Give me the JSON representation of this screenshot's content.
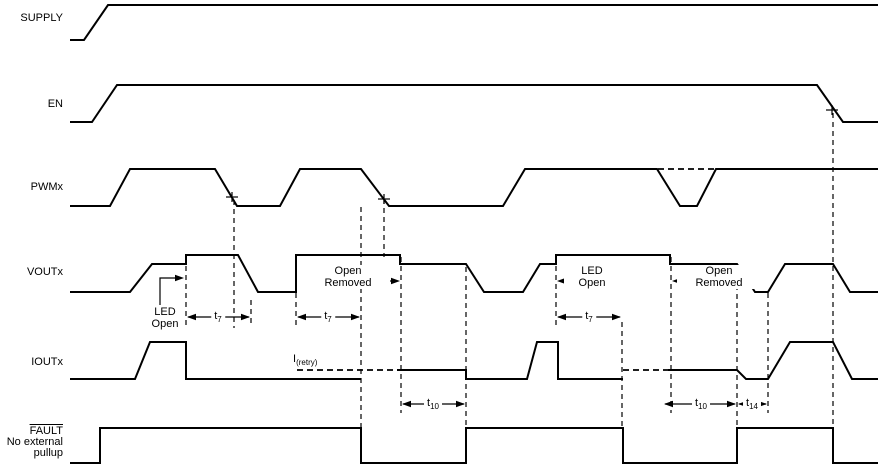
{
  "figure": {
    "background": "#ffffff",
    "line_color": "#000000"
  },
  "signals": {
    "supply": {
      "label": "SUPPLY"
    },
    "en": {
      "label": "EN"
    },
    "pwmx": {
      "label": "PWMx"
    },
    "voutx": {
      "label": "VOUTx"
    },
    "ioutx": {
      "label": "IOUTx"
    },
    "fault": {
      "label": "FAULT",
      "note_line1": "No external",
      "note_line2": "pullup"
    }
  },
  "annotations": {
    "led_open_1": {
      "line1": "LED",
      "line2": "Open"
    },
    "open_removed_1": {
      "line1": "Open",
      "line2": "Removed"
    },
    "led_open_2": {
      "line1": "LED",
      "line2": "Open"
    },
    "open_removed_2": {
      "line1": "Open",
      "line2": "Removed"
    },
    "i_retry": {
      "main": "I",
      "sub": "(retry)"
    }
  },
  "timing_labels": {
    "t7": {
      "main": "t",
      "sub": "7"
    },
    "t10": {
      "main": "t",
      "sub": "10"
    },
    "t14": {
      "main": "t",
      "sub": "14"
    }
  },
  "waveforms": {
    "solid": [
      {
        "name": "supply-waveform",
        "points": [
          [
            70,
            40
          ],
          [
            84,
            40
          ],
          [
            108,
            5
          ],
          [
            878,
            5
          ]
        ]
      },
      {
        "name": "en-waveform",
        "points": [
          [
            70,
            122
          ],
          [
            92,
            122
          ],
          [
            117,
            85
          ],
          [
            817,
            85
          ],
          [
            843,
            122
          ],
          [
            878,
            122
          ]
        ]
      },
      {
        "name": "pwmx-waveform",
        "points": [
          [
            70,
            206
          ],
          [
            110,
            206
          ],
          [
            130,
            169
          ],
          [
            215,
            169
          ],
          [
            237,
            206
          ],
          [
            280,
            206
          ],
          [
            300,
            169
          ],
          [
            361,
            169
          ],
          [
            389,
            206
          ],
          [
            503,
            206
          ],
          [
            525,
            169
          ],
          [
            657,
            169
          ],
          [
            680,
            206
          ],
          [
            697,
            206
          ],
          [
            716,
            169
          ],
          [
            878,
            169
          ]
        ]
      },
      {
        "name": "voutx-waveform",
        "points": [
          [
            70,
            292
          ],
          [
            130,
            292
          ],
          [
            152,
            264
          ],
          [
            186,
            264
          ],
          [
            186,
            255
          ],
          [
            238,
            255
          ],
          [
            258,
            292
          ],
          [
            296,
            292
          ],
          [
            296,
            255
          ],
          [
            400,
            255
          ],
          [
            400,
            264
          ],
          [
            466,
            264
          ],
          [
            484,
            292
          ],
          [
            523,
            292
          ],
          [
            540,
            264
          ],
          [
            556,
            264
          ],
          [
            556,
            255
          ],
          [
            670,
            255
          ],
          [
            670,
            264
          ],
          [
            737,
            264
          ],
          [
            755,
            292
          ],
          [
            768,
            292
          ],
          [
            785,
            264
          ],
          [
            833,
            264
          ],
          [
            850,
            292
          ],
          [
            878,
            292
          ]
        ]
      },
      {
        "name": "ioutx-waveform-1",
        "points": [
          [
            70,
            379
          ],
          [
            135,
            379
          ],
          [
            150,
            342
          ],
          [
            186,
            342
          ],
          [
            186,
            379
          ],
          [
            361,
            379
          ]
        ]
      },
      {
        "name": "ioutx-waveform-2",
        "points": [
          [
            397,
            370
          ],
          [
            466,
            370
          ],
          [
            466,
            379
          ],
          [
            527,
            379
          ],
          [
            537,
            342
          ],
          [
            558,
            342
          ],
          [
            558,
            379
          ],
          [
            623,
            379
          ]
        ]
      },
      {
        "name": "ioutx-waveform-3",
        "points": [
          [
            668,
            370
          ],
          [
            737,
            370
          ],
          [
            746,
            379
          ],
          [
            768,
            379
          ],
          [
            790,
            342
          ],
          [
            833,
            342
          ],
          [
            852,
            379
          ],
          [
            878,
            379
          ]
        ]
      },
      {
        "name": "fault-waveform",
        "points": [
          [
            70,
            463
          ],
          [
            100,
            463
          ],
          [
            100,
            428
          ],
          [
            361,
            428
          ],
          [
            361,
            463
          ],
          [
            466,
            463
          ],
          [
            466,
            428
          ],
          [
            623,
            428
          ],
          [
            623,
            463
          ],
          [
            737,
            463
          ],
          [
            737,
            428
          ],
          [
            833,
            428
          ],
          [
            833,
            463
          ],
          [
            878,
            463
          ]
        ]
      }
    ],
    "dashed_segments": [
      {
        "name": "pwmx-dip-dashed-level",
        "points": [
          [
            658,
            169
          ],
          [
            715,
            169
          ]
        ]
      },
      {
        "name": "ioutx-retry-dashed-left",
        "points": [
          [
            297,
            370
          ],
          [
            397,
            370
          ]
        ]
      },
      {
        "name": "ioutx-retry-dashed-right",
        "points": [
          [
            623,
            370
          ],
          [
            668,
            370
          ]
        ]
      }
    ],
    "dashed_verticals": [
      [
        186,
        257,
        328
      ],
      [
        234,
        200,
        328
      ],
      [
        251,
        300,
        326
      ],
      [
        296,
        257,
        328
      ],
      [
        361,
        207,
        428
      ],
      [
        384,
        199,
        257
      ],
      [
        401,
        257,
        413
      ],
      [
        466,
        267,
        428
      ],
      [
        556,
        257,
        326
      ],
      [
        622,
        322,
        428
      ],
      [
        671,
        257,
        413
      ],
      [
        737,
        267,
        428
      ],
      [
        768,
        293,
        413
      ],
      [
        833,
        113,
        428
      ]
    ],
    "plus_marks": [
      [
        232,
        197
      ],
      [
        384,
        199
      ],
      [
        832,
        110
      ]
    ],
    "dim_arrows": [
      {
        "label": "t7",
        "x1": 187,
        "x2": 250,
        "y": 317
      },
      {
        "label": "t7",
        "x1": 297,
        "x2": 360,
        "y": 317
      },
      {
        "label": "t7",
        "x1": 557,
        "x2": 621,
        "y": 317
      },
      {
        "label": "t10",
        "x1": 402,
        "x2": 465,
        "y": 404
      },
      {
        "label": "t10",
        "x1": 664,
        "x2": 736,
        "y": 404
      },
      {
        "label": "t14",
        "x1": 738,
        "x2": 767,
        "y": 404
      }
    ],
    "pointer_arrows": [
      {
        "name": "led-open-1-arrow",
        "points": [
          [
            160,
            305
          ],
          [
            160,
            278
          ],
          [
            180,
            278
          ]
        ],
        "tip": [
          184,
          278
        ],
        "dir": "right"
      },
      {
        "name": "open-removed-1-arrow",
        "points": [
          [
            383,
            281
          ],
          [
            396,
            281
          ]
        ],
        "tip": [
          400,
          281
        ],
        "dir": "right"
      },
      {
        "name": "led-open-2-arrow",
        "points": [
          [
            574,
            281
          ],
          [
            561,
            281
          ]
        ],
        "tip": [
          557,
          281
        ],
        "dir": "left"
      },
      {
        "name": "open-removed-2-arrow",
        "points": [
          [
            693,
            281
          ],
          [
            676,
            281
          ]
        ],
        "tip": [
          672,
          281
        ],
        "dir": "left"
      }
    ]
  }
}
